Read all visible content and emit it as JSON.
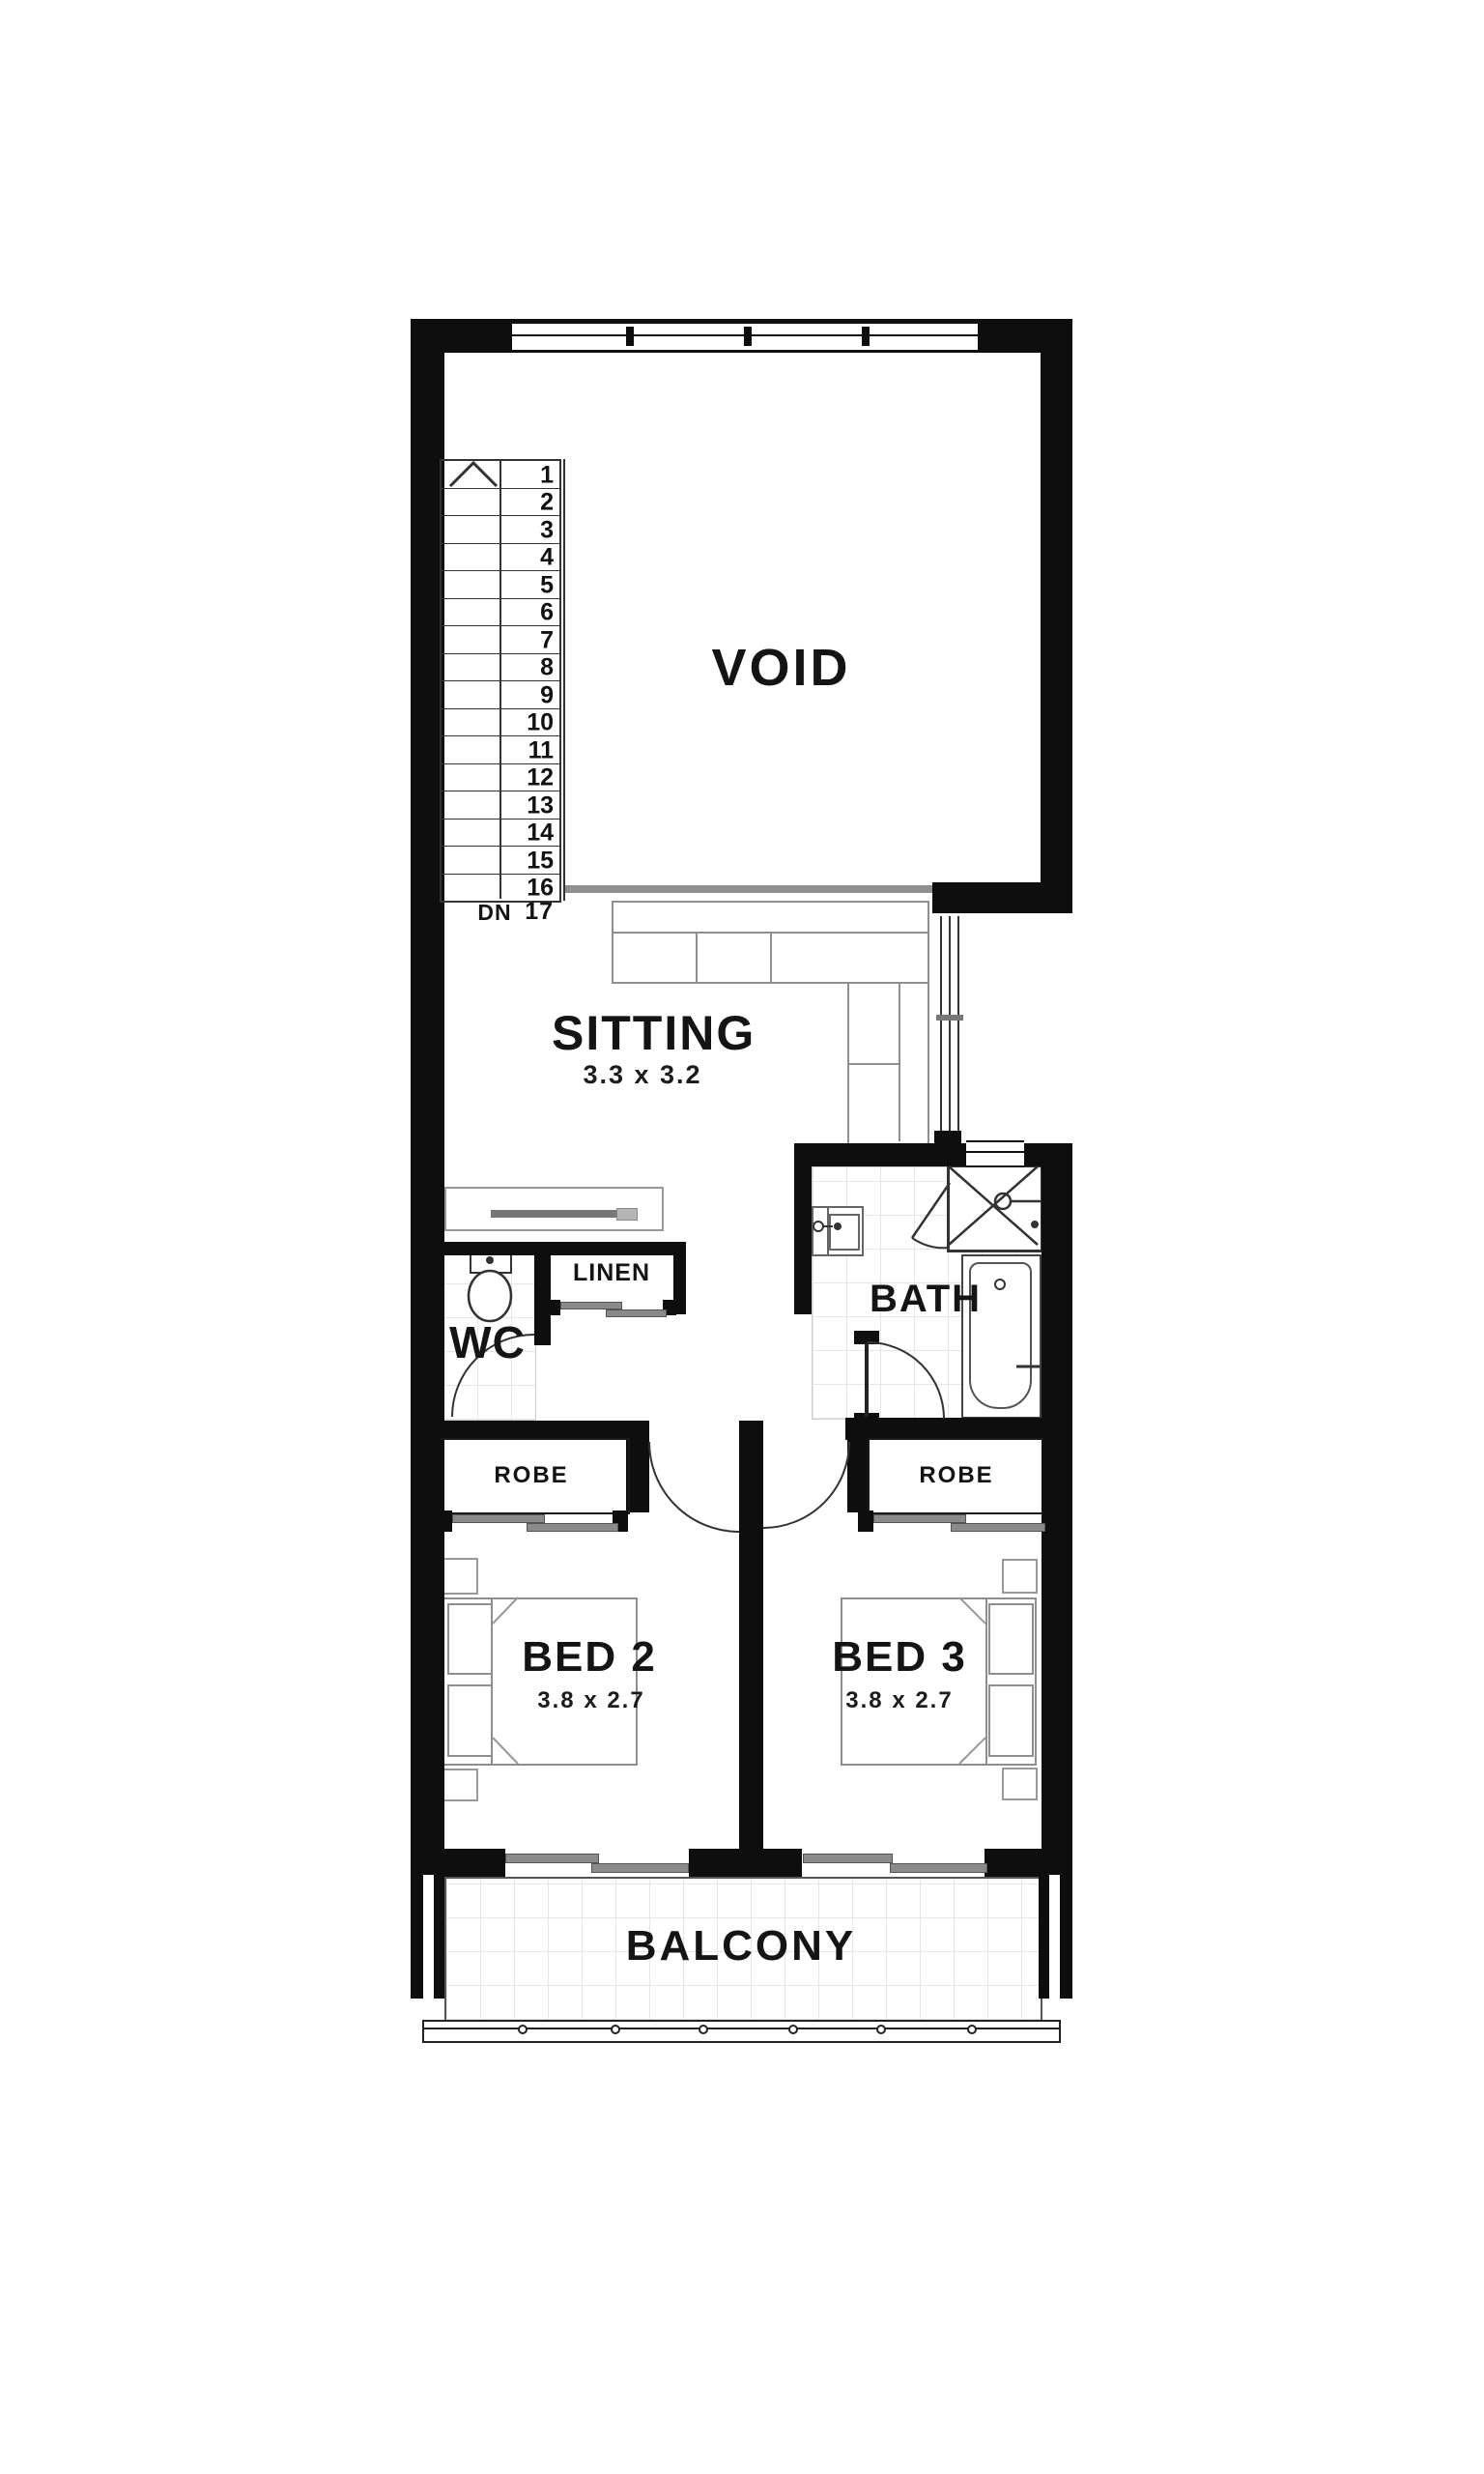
{
  "labels": {
    "void": "VOID",
    "sitting_name": "SITTING",
    "sitting_dims": "3.3 x 3.2",
    "linen": "LINEN",
    "wc": "WC",
    "bath": "BATH",
    "robe_left": "ROBE",
    "robe_right": "ROBE",
    "bed2_name": "BED 2",
    "bed2_dims": "3.8 x 2.7",
    "bed3_name": "BED 3",
    "bed3_dims": "3.8 x 2.7",
    "balcony": "BALCONY",
    "stairs_dn": "DN",
    "stairs_last": "17",
    "stairs_steps": [
      "1",
      "2",
      "3",
      "4",
      "5",
      "6",
      "7",
      "8",
      "9",
      "10",
      "11",
      "12",
      "13",
      "14",
      "15",
      "16"
    ]
  },
  "colors": {
    "wall": "#0e0e0e",
    "edge_gray": "#8f8f8f",
    "tile_line": "#e6e6e6"
  }
}
